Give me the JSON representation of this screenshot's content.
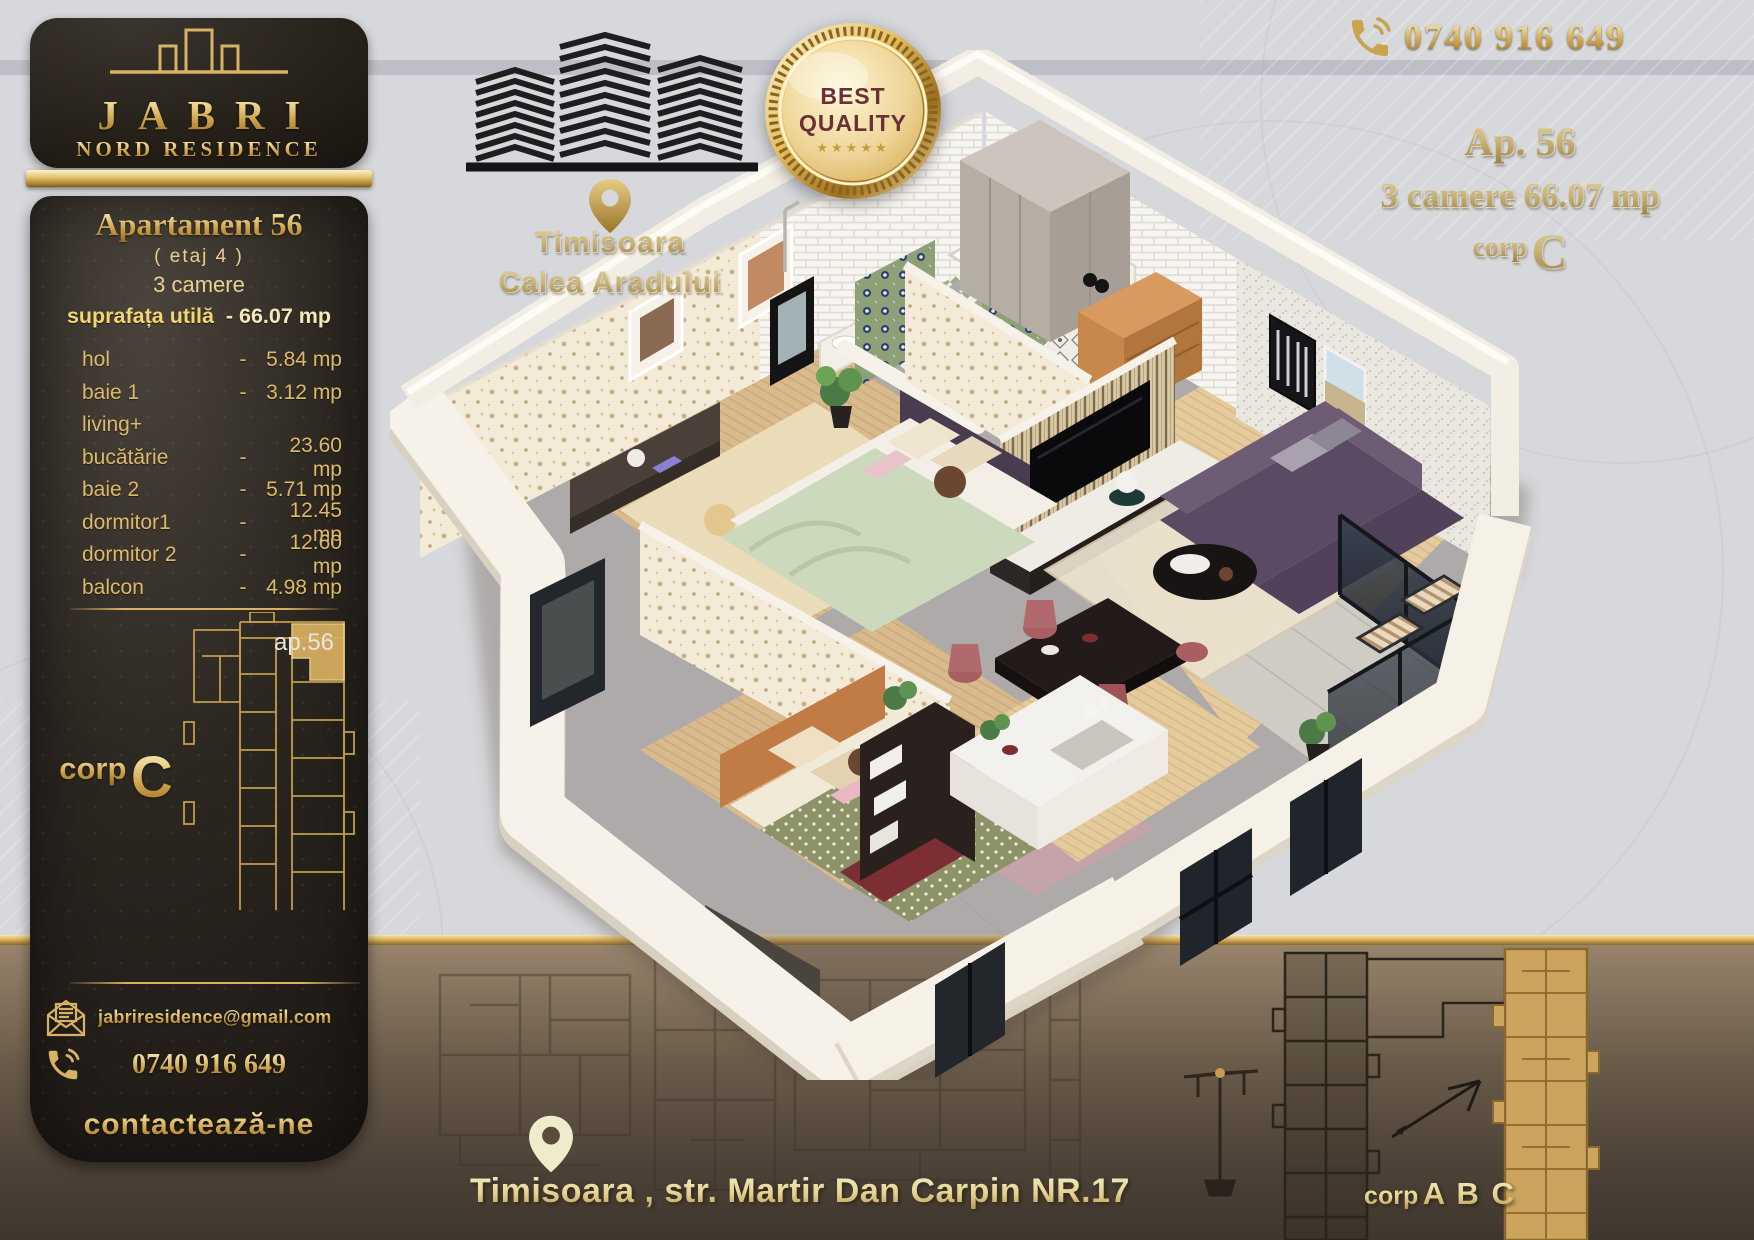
{
  "brand": {
    "name": "JABRI",
    "subtitle": "NORD RESIDENCE"
  },
  "sidebar": {
    "title": "Apartament 56",
    "floor_note": "( etaj 4 )",
    "rooms_note": "3 camere",
    "area_label": "suprafața utilă",
    "area_value": "- 66.07 mp",
    "rooms": [
      {
        "label": "hol",
        "dash": "-",
        "value": "5.84 mp"
      },
      {
        "label": "baie 1",
        "dash": "-",
        "value": "3.12 mp"
      },
      {
        "label": "living+",
        "dash": "",
        "value": ""
      },
      {
        "label": "bucătărie",
        "dash": "-",
        "value": "23.60 mp"
      },
      {
        "label": "baie 2",
        "dash": "-",
        "value": "5.71 mp"
      },
      {
        "label": "dormitor1",
        "dash": "-",
        "value": "12.45 mp"
      },
      {
        "label": "dormitor 2",
        "dash": "-",
        "value": "12.60 mp"
      },
      {
        "label": "balcon",
        "dash": "-",
        "value": "4.98 mp"
      }
    ],
    "plan_unit_label": "ap.56",
    "corp_prefix": "corp",
    "corp_letter": "C",
    "email": "jabriresidence@gmail.com",
    "phone": "0740 916 649",
    "cta": "contactează-ne"
  },
  "top_center": {
    "city": "Timisoara",
    "street": "Calea Aradului"
  },
  "badge": {
    "line1": "BEST",
    "line2": "QUALITY",
    "stars": "★★★★★"
  },
  "top_right": {
    "phone": "0740 916 649",
    "apartment": "Ap. 56",
    "details": "3 camere 66.07 mp",
    "corp_prefix": "corp",
    "corp_letter": "C"
  },
  "bottom": {
    "address": "Timisoara , str. Martir Dan Carpin NR.17",
    "site_corp_prefix": "corp",
    "site_corp_letters": "A B C"
  },
  "colors": {
    "gold": "#d7b264",
    "gold_bright": "#f4e4ae",
    "gold_deep": "#9a7428",
    "maroon": "#6b2f36",
    "background": "#d7d8db",
    "panel_dark": "#24201d",
    "band_brown": "#6a5c4b",
    "sofa_purple": "#5a4a63",
    "bed_green": "#ccd9bc",
    "bed_caramel": "#c07c44"
  }
}
